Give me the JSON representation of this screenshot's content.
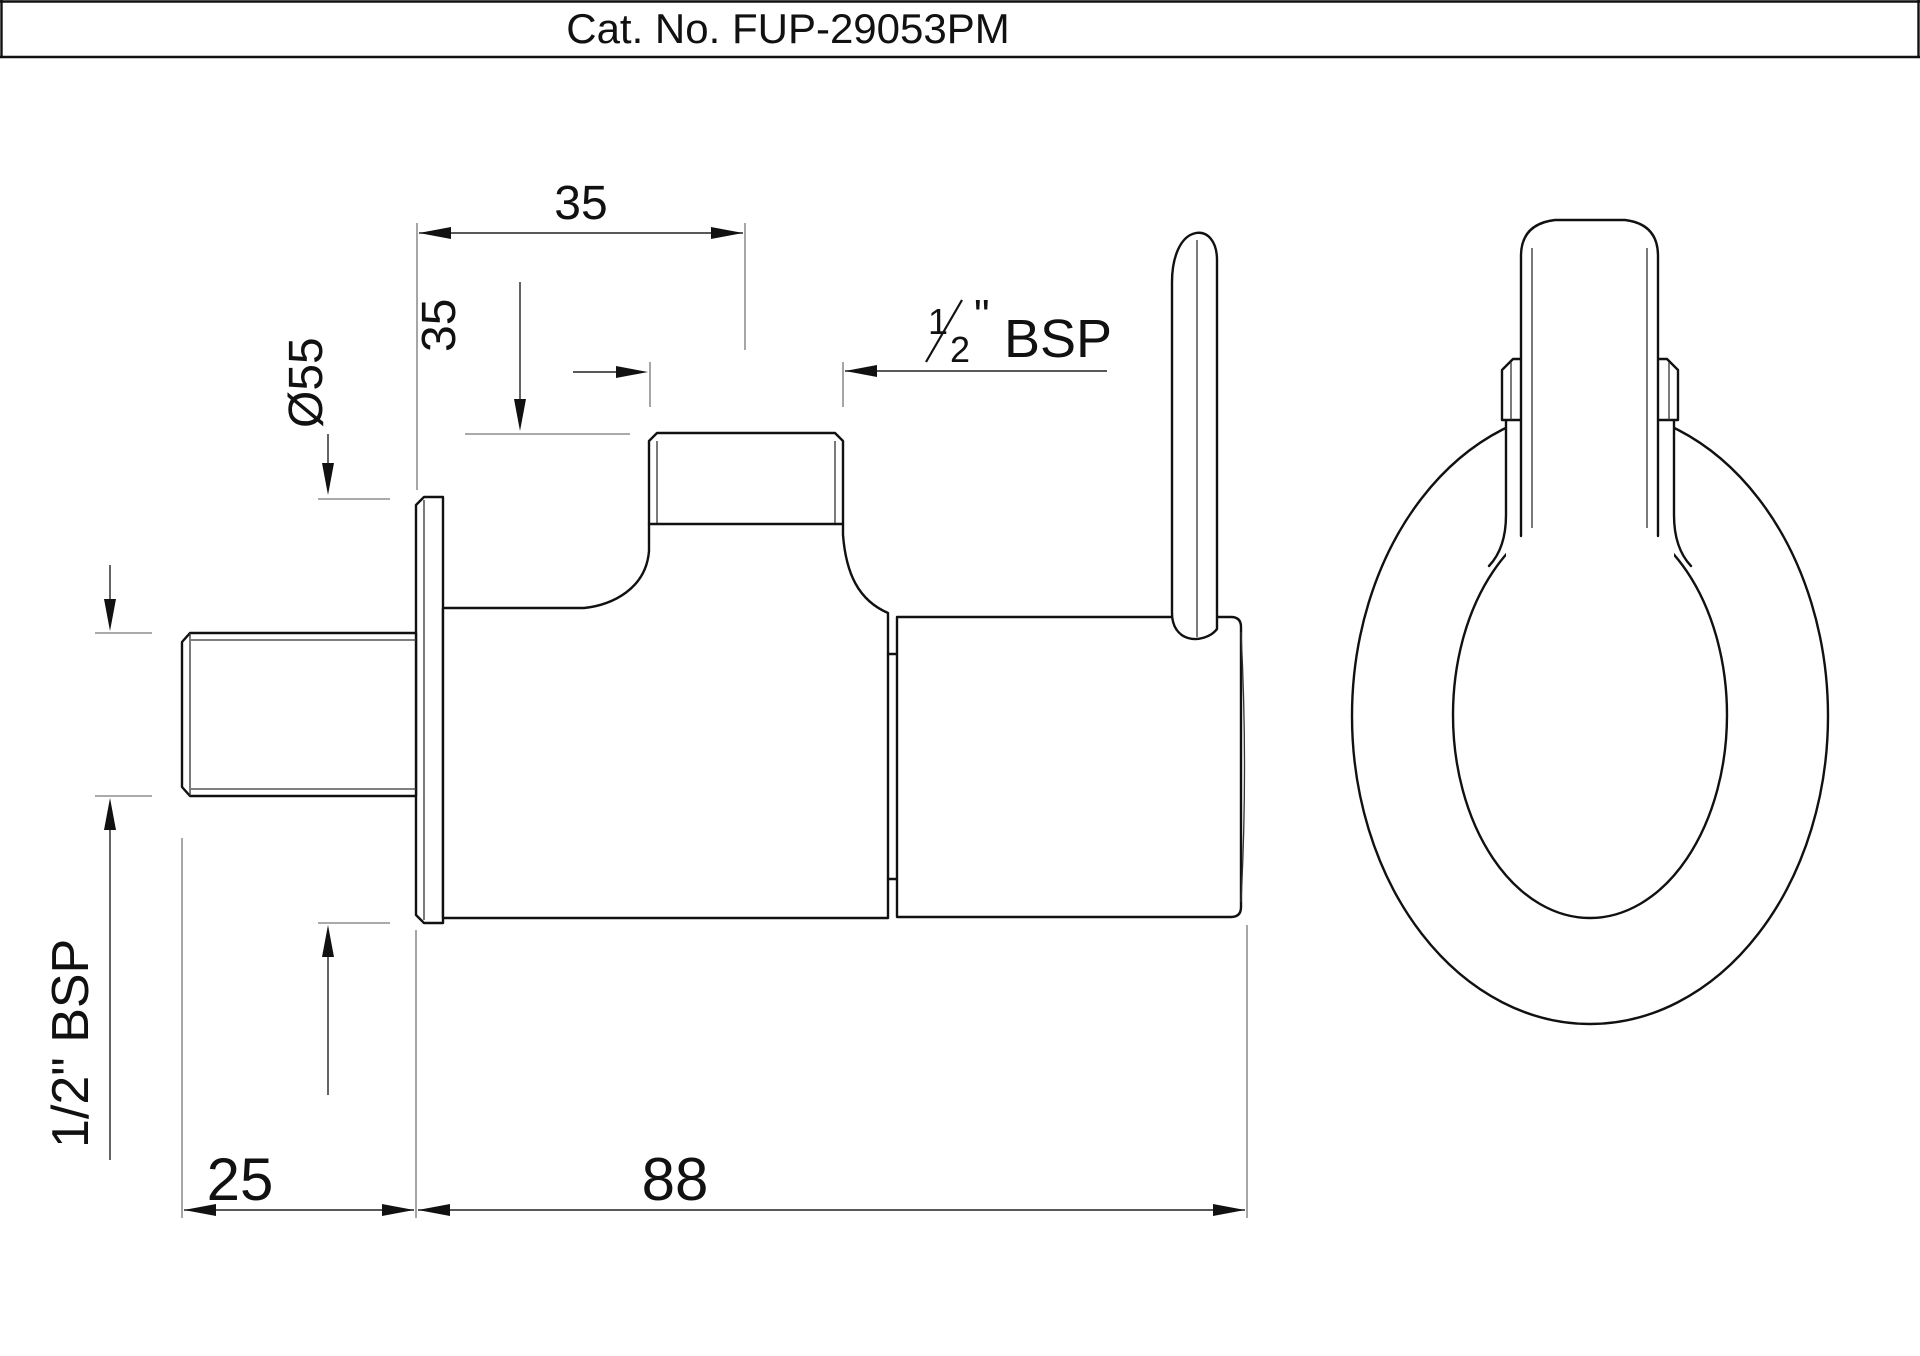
{
  "title": {
    "text": "Cat. No. FUP-29053PM"
  },
  "drawing": {
    "type": "technical-orthographic-drawing",
    "product": "angle-valve",
    "views": [
      "side-view",
      "front-view"
    ],
    "line_color": "#111111",
    "extension_line_color": "#777777",
    "background": "#ffffff"
  },
  "dimensions": {
    "top_width": "35",
    "port_height": "35",
    "flange_diameter": "Ø55",
    "outlet_thread": {
      "numerator": "1",
      "denominator": "2",
      "quote": "\"",
      "unit": "BSP"
    },
    "inlet_thread": "1/2\" BSP",
    "wall_offset": "25",
    "body_length": "88"
  }
}
